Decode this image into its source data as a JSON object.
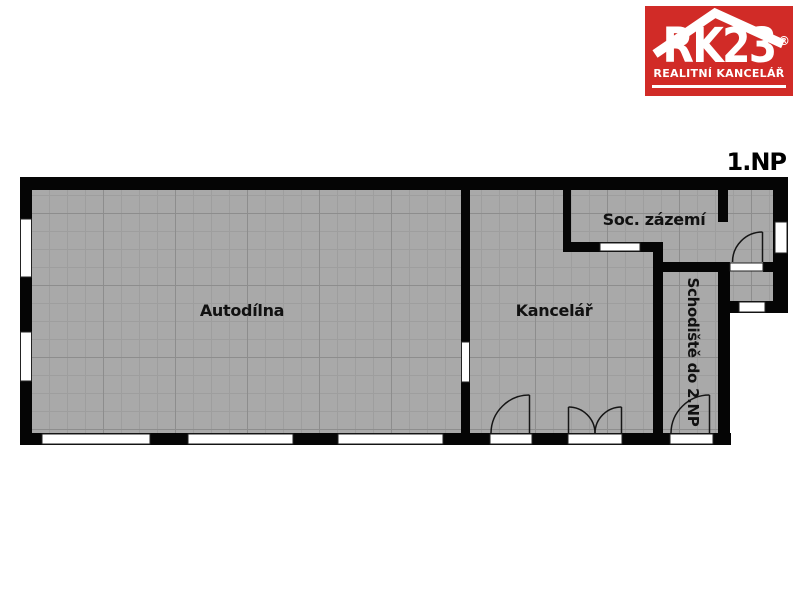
{
  "logo": {
    "brand": "RK23",
    "registered": "®",
    "subtitle": "REALITNÍ KANCELÁŘ",
    "bg_color": "#d12b27",
    "text_color": "#ffffff",
    "roof_icon": "house-roof"
  },
  "plan": {
    "floor_label": "1.NP",
    "rooms": {
      "autodilna": {
        "label": "Autodílna"
      },
      "kancelar": {
        "label": "Kancelář"
      },
      "soc_zazemi": {
        "label": "Soc. zázemí"
      },
      "schodiste": {
        "label": "Schodiště do 2.NP"
      }
    },
    "colors": {
      "wall": "#050505",
      "floor": "#a9a9a9",
      "grid_minor": "#9e9e9e",
      "grid_major": "#8d8d8d",
      "opening": "#ffffff"
    }
  }
}
